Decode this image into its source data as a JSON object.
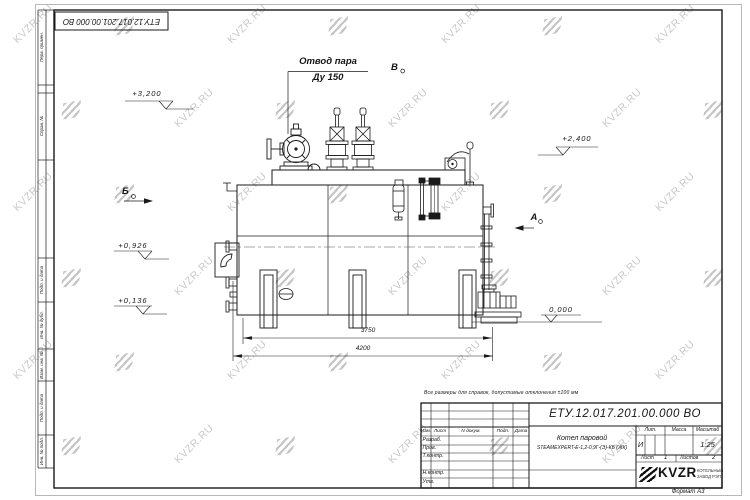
{
  "watermark": {
    "text": "KVZR.RU"
  },
  "frame": {
    "stamp": "ЕТУ.12.017.201.00.000 ВО",
    "side_labels": {
      "perv": "Перв. примен.",
      "sprav": "Справ. №",
      "podp1": "Подп. и дата",
      "inv_dubl": "Инв. № дубл.",
      "vzam": "Взам. инв. №",
      "podp2": "Подп. и дата",
      "inv_podl": "Инв. № подл."
    },
    "format": "Формат А3"
  },
  "annotations": {
    "leader_line1": "Отвод пара",
    "leader_line2": "Ду 150",
    "section_b": "Б",
    "section_v": "В",
    "section_a": "А",
    "elev_3200": "+3,200",
    "elev_2400": "+2,400",
    "elev_0926": "+0,926",
    "elev_0136": "+0,136",
    "elev_0000": "0,000",
    "dim_3750": "3750",
    "dim_4200": "4200",
    "note": "Все размеры для справок, допустимые отклонения ±100 мм"
  },
  "title_block": {
    "doc_number": "ЕТУ.12.017.201.00.000 ВО",
    "name_line1": "Котел паровой",
    "name_line2": "STEAMEXPERT-Е-1,2-0,9Г-(Э)-КБ (ЖК)",
    "col_izm": "Изм.",
    "col_list": "Лист",
    "col_dokum": "N докум.",
    "col_podp": "Подп.",
    "col_data": "Дата",
    "row_razrab": "Разраб.",
    "row_prov": "Пров.",
    "row_tkontr": "Т.контр.",
    "row_nkontr": "Н.контр.",
    "row_utv": "Утв.",
    "lit_label": "Лит.",
    "lit_value": "И",
    "mass_label": "Масса",
    "scale_label": "Масштаб",
    "scale_value": "1:25",
    "sheet_label": "Лист",
    "sheet_value": "1",
    "sheets_label": "Листов",
    "sheets_value": "2",
    "brand": "KVZR",
    "brand_sub1": "КОТЕЛЬНЫЙ",
    "brand_sub2": "ЗАВОД РЭП"
  }
}
